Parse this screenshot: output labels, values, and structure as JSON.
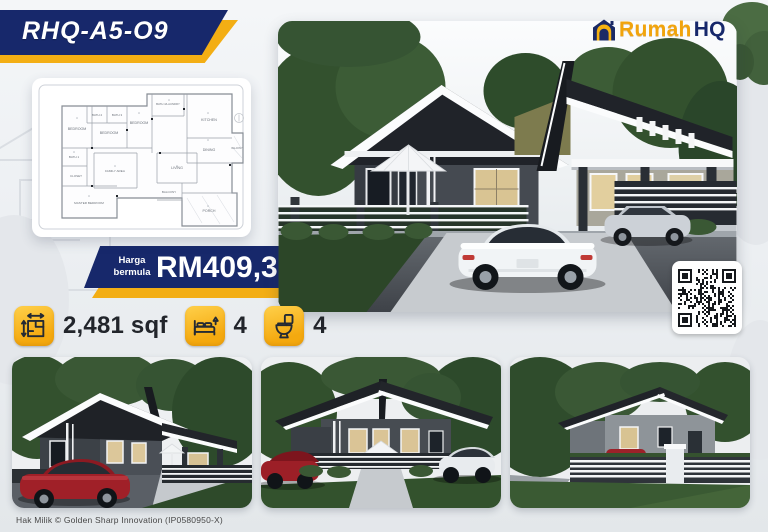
{
  "poster": {
    "plan_code": "RHQ-A5-O9",
    "brand": {
      "house_icon": "house-logo-icon",
      "name_primary": "Rumah",
      "name_secondary": "HQ"
    },
    "price": {
      "label_line1": "Harga",
      "label_line2": "bermula",
      "amount": "RM409,365"
    },
    "features": {
      "area": {
        "icon": "floor-area-icon",
        "value": "2,481 sqf"
      },
      "bedrooms": {
        "icon": "bed-icon",
        "value": "4"
      },
      "bathrooms": {
        "icon": "toilet-icon",
        "value": "4"
      }
    },
    "floor_plan": {
      "rooms": [
        "BEDROOM",
        "BATH 2",
        "BATH 3",
        "BEDROOM",
        "BEDROOM",
        "BATH 4/LAUNDRY",
        "KITCHEN",
        "DINING",
        "BALCONY",
        "BATH 1",
        "CLOSET",
        "FAMILY AREA",
        "LIVING",
        "MASTER BEDROOM",
        "BALCONY",
        "PORCH"
      ]
    },
    "footer": {
      "copyright": "Hak Milik © Golden Sharp Innovation (IP0580950-X)"
    },
    "colors": {
      "navy": "#17286b",
      "gold": "#f3ae14",
      "logo_orange": "#f1a40c"
    }
  }
}
